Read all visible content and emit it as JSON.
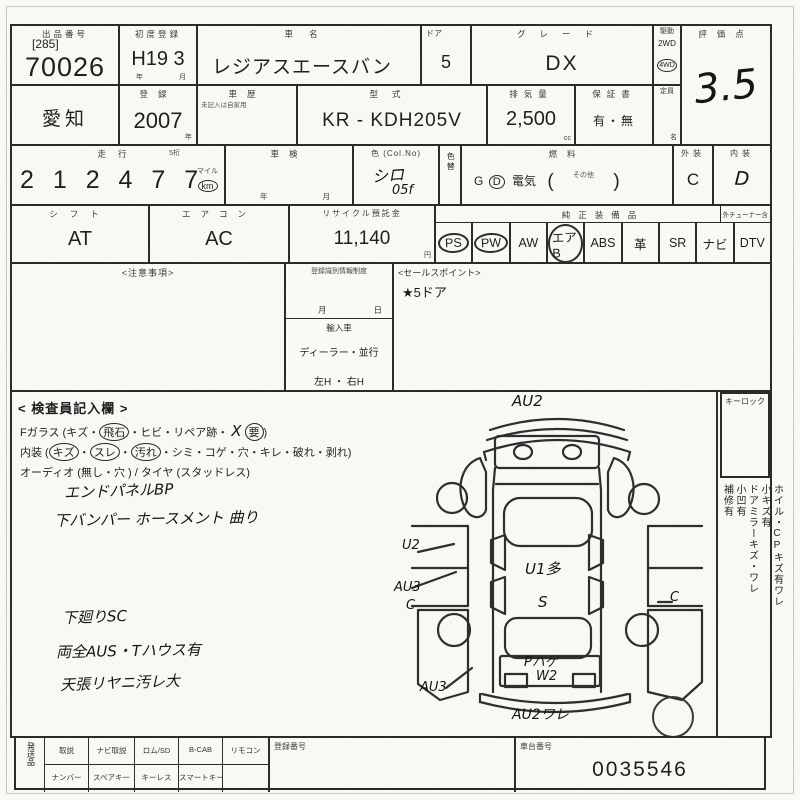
{
  "sheet": {
    "header": {
      "lot_label": "出品番号",
      "lot_bracket": "[285]",
      "lot_number": "70026",
      "first_reg_label": "初度登録",
      "first_reg_value": "H19 3",
      "year_char": "年",
      "month_char": "月",
      "car_name_label": "車名",
      "car_name": "レジアスエースバン",
      "door_label": "ドア",
      "door_count": "5",
      "grade_label": "グレード",
      "grade": "DX",
      "drive_label": "駆動",
      "drive_2wd": "2WD",
      "drive_4wd": "4WD",
      "score_label": "評価点",
      "score": "3.5"
    },
    "row2": {
      "prefecture": "愛知",
      "reg_label": "登録",
      "reg_year": "2007",
      "year_char": "年",
      "history_label": "車歴",
      "history_note": "未記入は自家用",
      "model_label": "型式",
      "model_code": "KR - KDH205V",
      "displacement_label": "排気量",
      "displacement": "2,500",
      "cc_unit": "cc",
      "warranty_label": "保証書",
      "warranty_value": "有・無",
      "capacity_label": "定員",
      "capacity_unit": "名"
    },
    "row3": {
      "mileage_label": "走行",
      "mileage_note": "5桁",
      "mileage": "2 1 2 4 7 7",
      "unit_mile": "マイル",
      "unit_km": "km",
      "shaken_label": "車検",
      "year_char": "年",
      "month_char": "月",
      "color_label": "色 (Col.No)",
      "color_value": "シロ",
      "color_no": "05f",
      "color_change_label": "色替",
      "fuel_label": "燃料",
      "fuel_g": "G",
      "fuel_d": "D",
      "fuel_elec": "電気",
      "fuel_other": "その他",
      "paren_open": "(",
      "paren_close": ")",
      "exterior_label": "外装",
      "exterior_grade": "C",
      "interior_label": "内装",
      "interior_grade": "D"
    },
    "row4": {
      "shift_label": "シフト",
      "shift": "AT",
      "aircon_label": "エアコン",
      "aircon": "AC",
      "recycle_label": "リサイクル預託金",
      "recycle_amount": "11,140",
      "yen_unit": "円",
      "equipment_label": "純正装備品",
      "tuner_note": "外チューナー含",
      "equipment": [
        {
          "label": "PS",
          "circled": true
        },
        {
          "label": "PW",
          "circled": true
        },
        {
          "label": "AW",
          "circled": false
        },
        {
          "label": "エアB",
          "circled": true
        },
        {
          "label": "ABS",
          "circled": false
        },
        {
          "label": "革",
          "circled": false
        },
        {
          "label": "SR",
          "circled": false
        },
        {
          "label": "ナビ",
          "circled": false
        },
        {
          "label": "DTV",
          "circled": false
        }
      ]
    },
    "middle": {
      "caution_label": "<注意事項>",
      "reg_id_label": "登録識別情報制度",
      "month_char": "月",
      "day_char": "日",
      "import_label": "輸入車",
      "import_options": "ディーラー・並行",
      "handle_options": "左H ・ 右H",
      "sales_label": "<セールスポイント>",
      "sales_point": "★5ドア"
    },
    "inspector": {
      "title": "< 検査員記入欄 >",
      "glass_line": {
        "p1": "Fガラス (キズ・",
        "p2": "飛石",
        "p3": "・ヒビ・リペア跡・",
        "mark": "X",
        "p4": "要",
        "p5": ")"
      },
      "interior_line": {
        "p1": "内装 (",
        "p2": "キズ",
        "p3": "・",
        "p4": "スレ",
        "p5": "・",
        "p6": "汚れ",
        "p7": "・シミ・コゲ・穴・キレ・破れ・剥れ)"
      },
      "audio_line": "オーディオ (無し・穴 ) / タイヤ (スタッドレス)",
      "notes": [
        "エンドパネルBP",
        "下バンパー ホースメント 曲り",
        "下廻りSC",
        "両全AUS・Tハウス有",
        "天張リヤニ汚レ大"
      ]
    },
    "diagram": {
      "annotations": [
        "AU2",
        "U2",
        "AU3",
        "C",
        "U1多",
        "S",
        "C",
        "Pハゲ",
        "W2",
        "AU3",
        "AU2ワレ"
      ]
    },
    "sidebar": {
      "key_lock_label": "キーロック",
      "lines": [
        "ホイル・CPキズ有ワレ",
        "小キズ有",
        "ドアミラーキズ・ワレ",
        "小凹有",
        "補修有"
      ]
    },
    "bottom": {
      "ship_label": "発送品",
      "row1": [
        "取説",
        "ナビ取説",
        "ロム/SD",
        "B-CAB",
        "リモコン"
      ],
      "row2": [
        "ナンバー",
        "スペアキー",
        "キーレス",
        "スマートキー"
      ],
      "reg_no_label": "登録番号",
      "chassis_label": "車台番号",
      "chassis_no": "0035546"
    },
    "colors": {
      "paper": "#faf9f5",
      "ink": "#2b2b2b",
      "pen": "#16160f"
    }
  }
}
